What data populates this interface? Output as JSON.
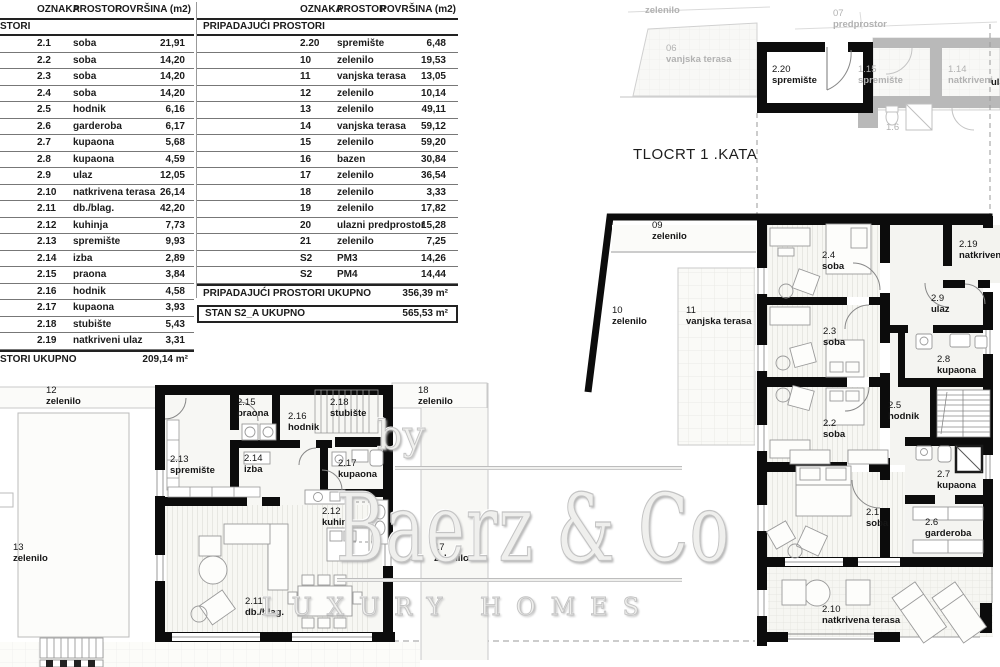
{
  "sheet": {
    "title": "TLOCRT 1 .KATA"
  },
  "watermark": {
    "by": "by",
    "name": "Baerz & Co",
    "tagline": "LUXURY HOMES"
  },
  "tables": {
    "t1": {
      "headers": [
        "OZNAKA",
        "PROSTOR",
        "POVRŠINA (m2)"
      ],
      "section": "STORI",
      "rows": [
        {
          "o": "2.1",
          "p": "soba",
          "a": "21,91"
        },
        {
          "o": "2.2",
          "p": "soba",
          "a": "14,20"
        },
        {
          "o": "2.3",
          "p": "soba",
          "a": "14,20"
        },
        {
          "o": "2.4",
          "p": "soba",
          "a": "14,20"
        },
        {
          "o": "2.5",
          "p": "hodnik",
          "a": "6,16"
        },
        {
          "o": "2.6",
          "p": "garderoba",
          "a": "6,17"
        },
        {
          "o": "2.7",
          "p": "kupaona",
          "a": "5,68"
        },
        {
          "o": "2.8",
          "p": "kupaona",
          "a": "4,59"
        },
        {
          "o": "2.9",
          "p": "ulaz",
          "a": "12,05"
        },
        {
          "o": "2.10",
          "p": "natkrivena terasa",
          "a": "26,14"
        },
        {
          "o": "2.11",
          "p": "db./blag.",
          "a": "42,20"
        },
        {
          "o": "2.12",
          "p": "kuhinja",
          "a": "7,73"
        },
        {
          "o": "2.13",
          "p": "spremište",
          "a": "9,93"
        },
        {
          "o": "2.14",
          "p": "izba",
          "a": "2,89"
        },
        {
          "o": "2.15",
          "p": "praona",
          "a": "3,84"
        },
        {
          "o": "2.16",
          "p": "hodnik",
          "a": "4,58"
        },
        {
          "o": "2.17",
          "p": "kupaona",
          "a": "3,93"
        },
        {
          "o": "2.18",
          "p": "stubište",
          "a": "5,43"
        },
        {
          "o": "2.19",
          "p": "natkriveni ulaz",
          "a": "3,31"
        }
      ],
      "total_label": "STORI UKUPNO",
      "total_value": "209,14 m²"
    },
    "t2": {
      "headers": [
        "OZNAKA",
        "PROSTOR",
        "POVRŠINA (m2)"
      ],
      "section": "PRIPADAJUĆI PROSTORI",
      "rows": [
        {
          "o": "2.20",
          "p": "spremište",
          "a": "6,48"
        },
        {
          "o": "10",
          "p": "zelenilo",
          "a": "19,53"
        },
        {
          "o": "11",
          "p": "vanjska terasa",
          "a": "13,05"
        },
        {
          "o": "12",
          "p": "zelenilo",
          "a": "10,14"
        },
        {
          "o": "13",
          "p": "zelenilo",
          "a": "49,11"
        },
        {
          "o": "14",
          "p": "vanjska terasa",
          "a": "59,12"
        },
        {
          "o": "15",
          "p": "zelenilo",
          "a": "59,20"
        },
        {
          "o": "16",
          "p": "bazen",
          "a": "30,84"
        },
        {
          "o": "17",
          "p": "zelenilo",
          "a": "36,54"
        },
        {
          "o": "18",
          "p": "zelenilo",
          "a": "3,33"
        },
        {
          "o": "19",
          "p": "zelenilo",
          "a": "17,82"
        },
        {
          "o": "20",
          "p": "ulazni predprostor",
          "a": "15,28"
        },
        {
          "o": "21",
          "p": "zelenilo",
          "a": "7,25"
        },
        {
          "o": "S2",
          "p": "PM3",
          "a": "14,26"
        },
        {
          "o": "S2",
          "p": "PM4",
          "a": "14,44"
        }
      ],
      "total_label": "PRIPADAJUĆI PROSTORI UKUPNO",
      "total_value": "356,39 m²",
      "stan_label": "STAN S2_A UKUPNO",
      "stan_value": "565,53 m²"
    }
  },
  "plans": {
    "labels": [
      {
        "n": "",
        "t": "zelenilo",
        "x": 645,
        "y": 6,
        "v": "g"
      },
      {
        "n": "06",
        "t": "vanjska terasa",
        "x": 666,
        "y": 44,
        "v": "g"
      },
      {
        "n": "07",
        "t": "predprostor",
        "x": 833,
        "y": 9,
        "v": "g"
      },
      {
        "n": "1.15",
        "t": "spremište",
        "x": 858,
        "y": 65,
        "v": "g"
      },
      {
        "n": "1.14",
        "t": "natkriveni",
        "x": 948,
        "y": 65,
        "v": "g"
      },
      {
        "n": "1.6",
        "t": "",
        "x": 886,
        "y": 123,
        "v": "g"
      },
      {
        "n": "",
        "t": "ula",
        "x": 991,
        "y": 78,
        "v": "cut"
      },
      {
        "n": "2.20",
        "t": "spremište",
        "x": 772,
        "y": 65,
        "v": "d"
      },
      {
        "n": "09",
        "t": "zelenilo",
        "x": 652,
        "y": 221,
        "v": "d"
      },
      {
        "n": "10",
        "t": "zelenilo",
        "x": 612,
        "y": 306,
        "v": "d"
      },
      {
        "n": "11",
        "t": "vanjska terasa",
        "x": 686,
        "y": 306,
        "v": "d"
      },
      {
        "n": "2.4",
        "t": "soba",
        "x": 822,
        "y": 251,
        "v": "d"
      },
      {
        "n": "2.3",
        "t": "soba",
        "x": 823,
        "y": 327,
        "v": "d"
      },
      {
        "n": "2.2",
        "t": "soba",
        "x": 823,
        "y": 419,
        "v": "d"
      },
      {
        "n": "2.9",
        "t": "ulaz",
        "x": 931,
        "y": 294,
        "v": "d"
      },
      {
        "n": "2.8",
        "t": "kupaona",
        "x": 937,
        "y": 355,
        "v": "d"
      },
      {
        "n": "2.5",
        "t": "hodnik",
        "x": 888,
        "y": 401,
        "v": "d"
      },
      {
        "n": "2.7",
        "t": "kupaona",
        "x": 937,
        "y": 470,
        "v": "d"
      },
      {
        "n": "2.1",
        "t": "soba",
        "x": 866,
        "y": 508,
        "v": "d"
      },
      {
        "n": "2.6",
        "t": "garderoba",
        "x": 925,
        "y": 518,
        "v": "d"
      },
      {
        "n": "2.10",
        "t": "natkrivena terasa",
        "x": 822,
        "y": 605,
        "v": "d"
      },
      {
        "n": "2.19",
        "t": "natkriven",
        "x": 959,
        "y": 240,
        "v": "d"
      },
      {
        "n": "12",
        "t": "zelenilo",
        "x": 46,
        "y": 386,
        "v": "d"
      },
      {
        "n": "13",
        "t": "zelenilo",
        "x": 13,
        "y": 543,
        "v": "d"
      },
      {
        "n": "18",
        "t": "zelenilo",
        "x": 418,
        "y": 386,
        "v": "d"
      },
      {
        "n": "17",
        "t": "zelenilo",
        "x": 434,
        "y": 543,
        "v": "d"
      },
      {
        "n": "2.13",
        "t": "spremište",
        "x": 170,
        "y": 455,
        "v": "d"
      },
      {
        "n": "2.15",
        "t": "praona",
        "x": 237,
        "y": 398,
        "v": "d"
      },
      {
        "n": "2.14",
        "t": "izba",
        "x": 244,
        "y": 454,
        "v": "d"
      },
      {
        "n": "2.16",
        "t": "hodnik",
        "x": 288,
        "y": 412,
        "v": "d"
      },
      {
        "n": "2.18",
        "t": "stubište",
        "x": 330,
        "y": 398,
        "v": "d"
      },
      {
        "n": "2.17",
        "t": "kupaona",
        "x": 338,
        "y": 459,
        "v": "d"
      },
      {
        "n": "2.12",
        "t": "kuhinja",
        "x": 322,
        "y": 507,
        "v": "d"
      },
      {
        "n": "2.11",
        "t": "db./blag.",
        "x": 245,
        "y": 597,
        "v": "d"
      }
    ]
  }
}
